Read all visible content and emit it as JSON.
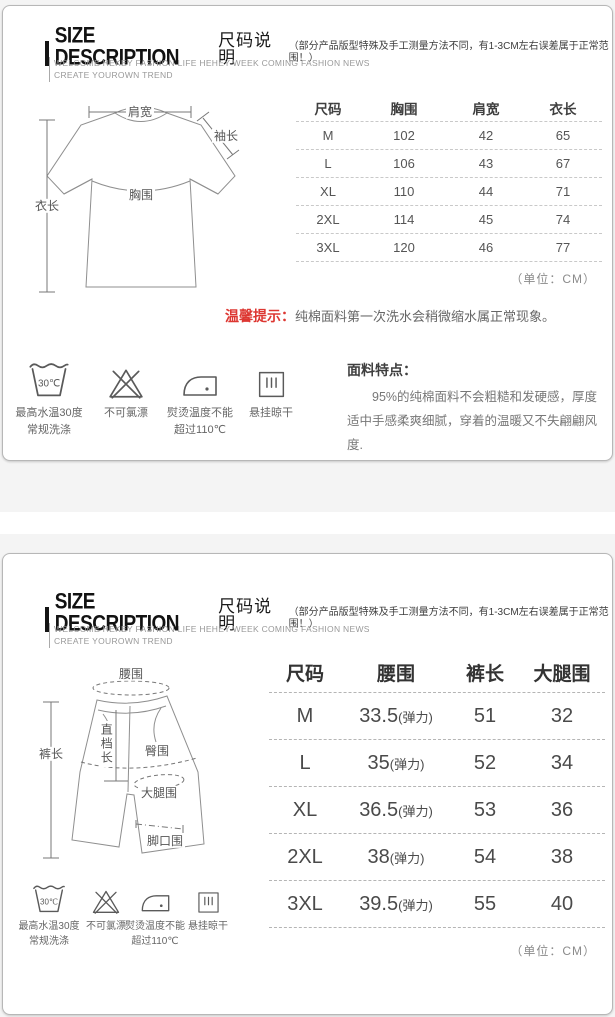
{
  "header": {
    "title_en": "SIZE DESCRIPTION",
    "title_cn": "尺码说明",
    "note": "（部分产品版型特殊及手工测量方法不同，有1-3CM左右误差属于正常范围！）",
    "tagline1": "WELCOME HEKEY FASHION LIFE HEHEY WEEK COMING FASHION NEWS",
    "tagline2": "CREATE YOUROWN TREND"
  },
  "unit_note": "（单位：CM）",
  "colors": {
    "accent_red": "#dd3732"
  },
  "tshirt": {
    "diagram": {
      "shoulder": "肩宽",
      "sleeve": "袖长",
      "length": "衣长",
      "chest": "胸围"
    },
    "table": {
      "headers": [
        "尺码",
        "胸围",
        "肩宽",
        "衣长"
      ],
      "rows": [
        [
          "M",
          "102",
          "42",
          "65"
        ],
        [
          "L",
          "106",
          "43",
          "67"
        ],
        [
          "XL",
          "110",
          "44",
          "71"
        ],
        [
          "2XL",
          "114",
          "45",
          "74"
        ],
        [
          "3XL",
          "120",
          "46",
          "77"
        ]
      ]
    },
    "tip_label": "温馨提示：",
    "tip_text": "纯棉面料第一次洗水会稍微缩水属正常现象。",
    "fabric_title": "面料特点：",
    "fabric_text": "95%的纯棉面料不会粗糙和发硬感，厚度适中手感柔爽细腻，穿着的温暖又不失翩翩风度."
  },
  "shorts": {
    "diagram": {
      "waist": "腰围",
      "length": "裤长",
      "rise": "直档长",
      "hip": "臀围",
      "thigh": "大腿围",
      "hem": "脚口围"
    },
    "table": {
      "headers": [
        "尺码",
        "腰围",
        "裤长",
        "大腿围"
      ],
      "rows": [
        {
          "size": "M",
          "waist": "33.5",
          "elastic": "(弹力)",
          "len": "51",
          "thigh": "32"
        },
        {
          "size": "L",
          "waist": "35",
          "elastic": "(弹力)",
          "len": "52",
          "thigh": "34"
        },
        {
          "size": "XL",
          "waist": "36.5",
          "elastic": "(弹力)",
          "len": "53",
          "thigh": "36"
        },
        {
          "size": "2XL",
          "waist": "38",
          "elastic": "(弹力)",
          "len": "54",
          "thigh": "38"
        },
        {
          "size": "3XL",
          "waist": "39.5",
          "elastic": "(弹力)",
          "len": "55",
          "thigh": "40"
        }
      ]
    }
  },
  "care": {
    "wash": {
      "glyph": "30℃",
      "line1": "最高水温30度",
      "line2": "常规洗涤"
    },
    "bleach": {
      "line1": "不可氯漂"
    },
    "iron": {
      "line1": "熨烫温度不能",
      "line2": "超过110℃"
    },
    "hang": {
      "line1": "悬挂晾干"
    }
  }
}
